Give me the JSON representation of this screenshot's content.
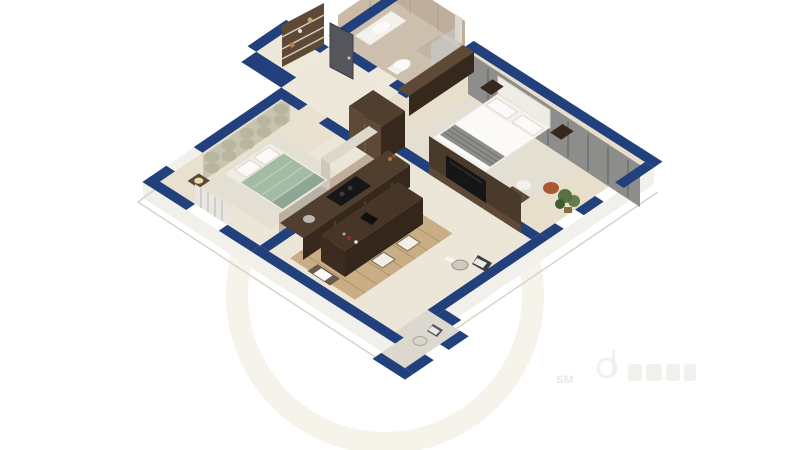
{
  "watermark": {
    "sm": "SM",
    "logo": "illegible-logotype"
  },
  "colors": {
    "wall": "#21407c",
    "wallDark": "#182f5c",
    "floorBath": "#cdbfae",
    "floorHall": "#eee8da",
    "floorBed1": "#e9e1d0",
    "floorMaster": "#e7decb",
    "floorKL": "#ece6d8",
    "floorBalc": "#dcd8cf",
    "rug": "#e4dfd3",
    "woodFloor": "#c9ad84",
    "woodFloorLine": "#b3946a",
    "wood": "#503e2f",
    "woodDark": "#36281c",
    "woodMid": "#5d4936",
    "marble": "#bfae9c",
    "marble2": "#cbbaa8",
    "marbleVein": "#a89584",
    "sage": "#c7c4af",
    "sageCircle": "#b9b6a0",
    "green": "#a3bba4",
    "greenLight": "#c2d2bd",
    "greenDark": "#8fa695",
    "gray": "#8d8d8b",
    "grayDark": "#6f6f6d",
    "white": "#f3f1ec",
    "whiteBright": "#fbfaf8",
    "doorGray": "#55565c",
    "glass": "#c9d4d8",
    "black": "#161616",
    "rust": "#ad5730",
    "plant": "#4e6b3a",
    "slab": "#f2f0ea",
    "slabLine": "#d6d3ca",
    "radiator": "#e8e6e0",
    "wmCircle": "#efe9d8",
    "wmtext": "#e6e4df",
    "wmlogo": "#f1efea"
  },
  "scene": {
    "type": "isometric-cutaway-floor-plan",
    "rooms": [
      {
        "name": "bedroom-1"
      },
      {
        "name": "entry-hall"
      },
      {
        "name": "bathroom"
      },
      {
        "name": "master-bedroom"
      },
      {
        "name": "kitchen"
      },
      {
        "name": "living-dining"
      },
      {
        "name": "balcony"
      }
    ]
  }
}
